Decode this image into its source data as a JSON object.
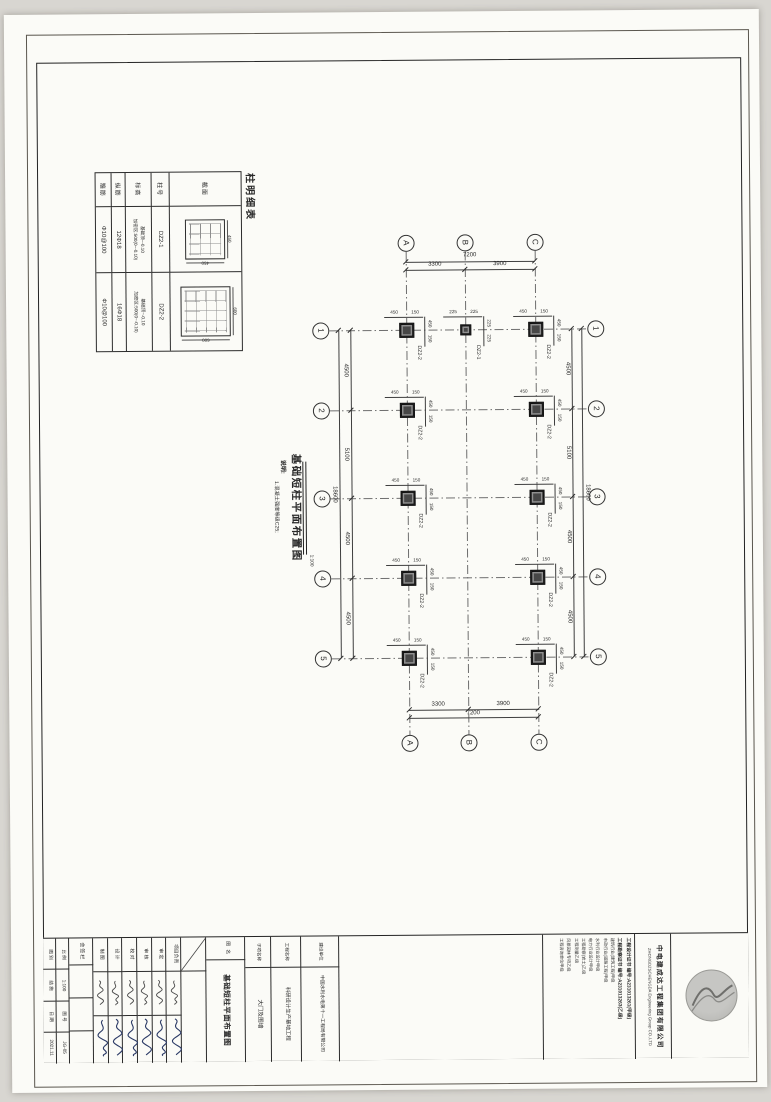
{
  "column_table": {
    "title": "柱明细表",
    "row_labels": [
      "截面",
      "柱号",
      "标高",
      "纵筋",
      "箍筋"
    ],
    "entries": [
      {
        "section_dim": "450",
        "id": "DZ2-1",
        "elevation": [
          "基础顶~-0.10",
          "加密区:500(0~-0.10)"
        ],
        "main_bars": "12Φ18",
        "stirrups": "Φ10@100"
      },
      {
        "section_dim": "600",
        "id": "DZ2-2",
        "elevation": [
          "基础顶~-0.10",
          "加密区:500(0~-0.10)"
        ],
        "main_bars": "16Φ18",
        "stirrups": "Φ10@100"
      }
    ]
  },
  "plan": {
    "title": "基础短柱平面布置图",
    "scale": "1:100",
    "note_label": "说明:",
    "note": "1.混凝土强度等级C25;",
    "grid": {
      "h_axes": [
        "A",
        "B",
        "C"
      ],
      "v_axes": [
        "1",
        "2",
        "3",
        "4",
        "5"
      ],
      "top": {
        "segments": [
          "3300",
          "3900"
        ],
        "total": "7200"
      },
      "bottom": {
        "segments": [
          "3300",
          "3900"
        ],
        "total": "7200"
      },
      "left": {
        "segments": [
          "4500",
          "5100",
          "4500",
          "4500"
        ],
        "total": "18600"
      },
      "right": {
        "segments": [
          "4500",
          "5100",
          "4500",
          "4500"
        ],
        "total": "18600"
      }
    },
    "columns": [
      {
        "axis": "A",
        "row": 1,
        "label": "DZ2-2",
        "dims_top": [
          "450",
          "150"
        ],
        "dims_side": [
          "450",
          "150"
        ]
      },
      {
        "axis": "B",
        "row": 1,
        "label": "DZ2-1",
        "dims_top": [
          "225",
          "225"
        ],
        "dims_side": [
          "225",
          "225"
        ]
      },
      {
        "axis": "C",
        "row": 1,
        "label": "DZ2-2",
        "dims_top": [
          "450",
          "150"
        ],
        "dims_side": [
          "450",
          "150"
        ]
      },
      {
        "axis": "A",
        "row": 2,
        "label": "DZ2-2",
        "dims_top": [
          "450",
          "150"
        ],
        "dims_side": [
          "450",
          "150"
        ]
      },
      {
        "axis": "C",
        "row": 2,
        "label": "DZ2-2",
        "dims_top": [
          "450",
          "150"
        ],
        "dims_side": [
          "450",
          "150"
        ]
      },
      {
        "axis": "A",
        "row": 3,
        "label": "DZ2-2",
        "dims_top": [
          "450",
          "150"
        ],
        "dims_side": [
          "450",
          "150"
        ]
      },
      {
        "axis": "C",
        "row": 3,
        "label": "DZ2-2",
        "dims_top": [
          "450",
          "150"
        ],
        "dims_side": [
          "450",
          "150"
        ]
      },
      {
        "axis": "A",
        "row": 4,
        "label": "DZ2-2",
        "dims_top": [
          "450",
          "150"
        ],
        "dims_side": [
          "450",
          "150"
        ]
      },
      {
        "axis": "C",
        "row": 4,
        "label": "DZ2-2",
        "dims_top": [
          "450",
          "150"
        ],
        "dims_side": [
          "450",
          "150"
        ]
      },
      {
        "axis": "A",
        "row": 5,
        "label": "DZ2-2",
        "dims_top": [
          "450",
          "150"
        ],
        "dims_side": [
          "450",
          "150"
        ]
      },
      {
        "axis": "C",
        "row": 5,
        "label": "DZ2-2",
        "dims_top": [
          "450",
          "150"
        ],
        "dims_side": [
          "450",
          "150"
        ]
      }
    ]
  },
  "title_block": {
    "info_cols": [
      {
        "cells": [
          "图 别",
          "结 施",
          "日 期",
          "2021.11"
        ]
      },
      {
        "cells": [
          "比 例",
          "1:100",
          "图 号",
          "JG-05"
        ]
      }
    ],
    "huiqian_label": "会签栏",
    "signature_cols": [
      "制 图",
      "设 计",
      "校 对",
      "审 核",
      "审 定",
      "项目负责"
    ],
    "name_label": "图 名",
    "drawing_name": "基础短柱平面布置图",
    "sections": [
      {
        "label": "子项名称",
        "value": "大门及围墙"
      },
      {
        "label": "工程名称",
        "value": "科研设计生产基地工程"
      },
      {
        "label": "建设单位",
        "value": "中国水利水电第十一工程局有限公司"
      }
    ],
    "credentials": {
      "cert_lines": [
        "工程设计证书 编号:A231013261(甲级)",
        "工程勘察证书 编号:A231013263(乙级)"
      ],
      "qual_lines": [
        "建筑行业(建筑工程)甲级",
        "市政行业(道路工程)甲级",
        "水利行业设计甲级",
        "电力行业设计甲级",
        "工程勘察(岩土)乙级",
        "工程测量乙级",
        "风景园林专项乙级",
        "工程咨询单位甲级"
      ]
    },
    "company": {
      "cn": "中电建成达工程集团有限公司",
      "en": "ZHONGDZSCHENGDA Engineering Group CO.,LTD"
    }
  }
}
